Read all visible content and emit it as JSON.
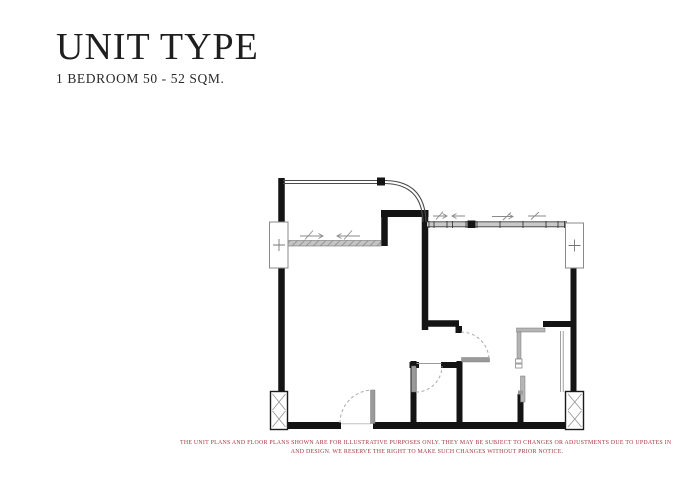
{
  "header": {
    "title": "UNIT TYPE",
    "subtitle": "1 BEDROOM 50 - 52 SQM."
  },
  "plan": {
    "label": "1-bedroom unit floor plan",
    "colors": {
      "wall": "#141414",
      "glazing_fill": "#c9c9c9",
      "glazing_line": "#3a3a3a",
      "fixture": "#9a9a9a",
      "swing_arc": "#ababab",
      "railing": "#4a4a4a",
      "column_border": "#8a8a8a"
    },
    "features": [
      "balcony",
      "balcony-railing",
      "sliding-glass-door",
      "living-area",
      "bedroom",
      "bathroom",
      "entrance-door",
      "window-wall",
      "structural-columns",
      "service-shafts"
    ]
  },
  "disclaimer": {
    "color": "#a2383f",
    "line1": "THE UNIT PLANS AND FLOOR PLANS SHOWN ARE FOR ILLUSTRATIVE PURPOSES ONLY. THEY MAY BE SUBJECT TO CHANGES OR ADJUSTMENTS DUE TO UPDATES IN THE BUILDING'S STRUCTURE",
    "line2": "AND DESIGN. WE RESERVE THE RIGHT TO MAKE SUCH CHANGES WITHOUT PRIOR NOTICE."
  }
}
